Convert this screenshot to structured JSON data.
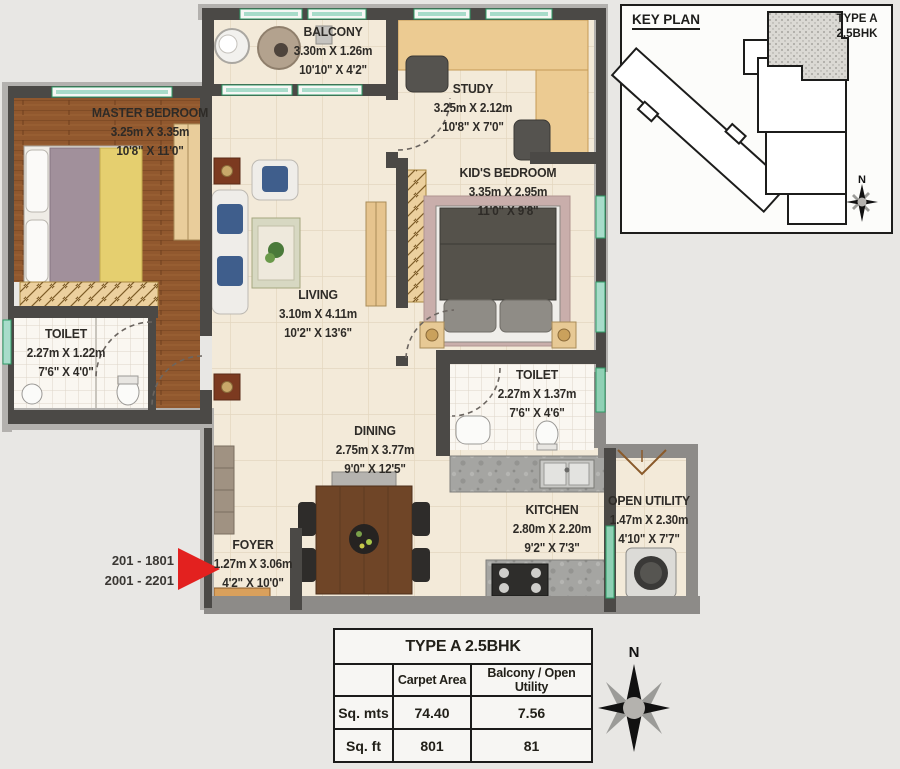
{
  "plan": {
    "rooms": [
      {
        "name": "BALCONY",
        "metric": "3.30m X 1.26m",
        "imperial": "10'10\" X 4'2\""
      },
      {
        "name": "MASTER BEDROOM",
        "metric": "3.25m X 3.35m",
        "imperial": "10'8\" X 11'0\""
      },
      {
        "name": "STUDY",
        "metric": "3.25m X 2.12m",
        "imperial": "10'8\" X 7'0\""
      },
      {
        "name": "KID'S BEDROOM",
        "metric": "3.35m X 2.95m",
        "imperial": "11'0\" X 9'8\""
      },
      {
        "name": "TOILET",
        "metric": "2.27m X 1.22m",
        "imperial": "7'6\" X 4'0\""
      },
      {
        "name": "LIVING",
        "metric": "3.10m X 4.11m",
        "imperial": "10'2\" X 13'6\""
      },
      {
        "name": "TOILET",
        "metric": "2.27m X 1.37m",
        "imperial": "7'6\" X 4'6\""
      },
      {
        "name": "DINING",
        "metric": "2.75m X 3.77m",
        "imperial": "9'0\" X 12'5\""
      },
      {
        "name": "KITCHEN",
        "metric": "2.80m X 2.20m",
        "imperial": "9'2\" X 7'3\""
      },
      {
        "name": "OPEN UTILITY",
        "metric": "1.47m X 2.30m",
        "imperial": "4'10\" X 7'7\""
      },
      {
        "name": "FOYER",
        "metric": "1.27m X 3.06m",
        "imperial": "4'2\" X 10'0\""
      }
    ],
    "floor_range_line1": "201 - 1801",
    "floor_range_line2": "2001 - 2201"
  },
  "key_plan": {
    "title": "KEY PLAN",
    "type_line1": "TYPE A",
    "type_line2": "2.5BHK",
    "north": "N"
  },
  "compass": {
    "north": "N"
  },
  "area_table": {
    "title": "TYPE A 2.5BHK",
    "col1": "Carpet Area",
    "col2": "Balcony / Open Utility",
    "rows": [
      {
        "label": "Sq. mts",
        "carpet": "74.40",
        "balcony": "7.56"
      },
      {
        "label": "Sq. ft",
        "carpet": "801",
        "balcony": "81"
      }
    ]
  },
  "colors": {
    "accent_red": "#e3211f",
    "wall_dark": "#4b4946",
    "floor_cream": "#f3ead9",
    "wood": "#91582e",
    "window_green": "#2f9e68",
    "window_teal": "#a8dcca"
  }
}
